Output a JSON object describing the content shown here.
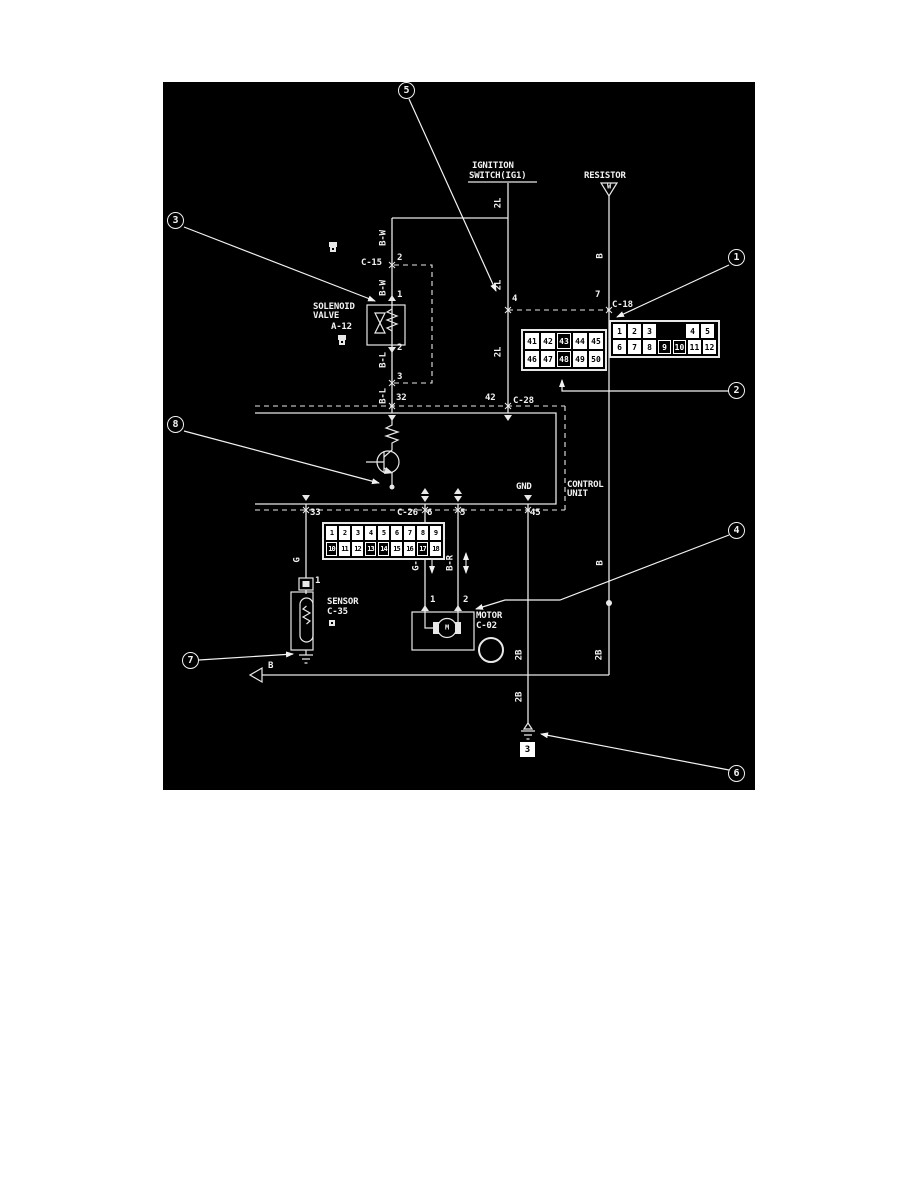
{
  "diagram": {
    "background": "#000000",
    "foreground": "#f2f2f2",
    "callouts": {
      "c1": "1",
      "c2": "2",
      "c3": "3",
      "c4": "4",
      "c5": "5",
      "c6": "6",
      "c7": "7",
      "c8": "8"
    }
  },
  "components": {
    "ignition_switch": {
      "line1": "IGNITION",
      "line2": "SWITCH(IG1)"
    },
    "resistor": {
      "label": "RESISTOR",
      "symbol_letter": "W"
    },
    "solenoid_valve": {
      "line1": "SOLENOID",
      "line2": "VALVE",
      "connector": "A-12"
    },
    "control_unit": {
      "line1": "CONTROL",
      "line2": "UNIT",
      "gnd_label": "GND"
    },
    "sensor": {
      "label": "SENSOR",
      "connector": "C-35"
    },
    "motor": {
      "label": "MOTOR",
      "connector": "C-02",
      "symbol_letter": "M"
    },
    "ground_ref": "3",
    "offpage_label": "B"
  },
  "connectors": {
    "c15": {
      "label": "C-15",
      "rows": [
        [
          "1",
          "2"
        ],
        [
          "3",
          "4"
        ]
      ]
    },
    "a12": {
      "rows": [
        [
          "1"
        ],
        [
          "2"
        ]
      ]
    },
    "c18": {
      "label": "C-18",
      "rows": [
        [
          "1",
          "2",
          "3",
          "",
          "4",
          "5"
        ],
        [
          "6",
          "7",
          "8",
          "9",
          "10",
          "11",
          "12"
        ]
      ],
      "filled": [
        "9",
        "10"
      ]
    },
    "c28": {
      "label": "C-28",
      "rows": [
        [
          "41",
          "42",
          "43",
          "44",
          "45"
        ],
        [
          "46",
          "47",
          "48",
          "49",
          "50"
        ]
      ],
      "filled": [
        "43",
        "48"
      ]
    },
    "c26": {
      "label": "C-26",
      "rows": [
        [
          "1",
          "2",
          "3",
          "4",
          "5",
          "6",
          "7",
          "8",
          "9"
        ],
        [
          "10",
          "11",
          "12",
          "13",
          "14",
          "15",
          "16",
          "17",
          "18"
        ]
      ],
      "filled": [
        "10",
        "13",
        "14",
        "17"
      ]
    },
    "c02_icon": {
      "rows": [
        [
          "1",
          "2"
        ]
      ]
    },
    "c35_icon": {
      "rows": [
        [
          "1"
        ]
      ]
    }
  },
  "pins": {
    "c15_top": "2",
    "valve_in": "1",
    "valve_out": "2",
    "c15_bottom": "3",
    "cu_32": "32",
    "cu_42": "42",
    "c18_4": "4",
    "c18_7": "7",
    "cu_33": "33",
    "cu_6": "6",
    "cu_5": "5",
    "cu_45": "45",
    "motor_1": "1",
    "motor_2": "2",
    "sensor_1": "1"
  },
  "wire_labels": {
    "l2l_a": "2L",
    "l2l_b": "2L",
    "l2l_c": "2L",
    "bw_a": "B-W",
    "bw_b": "B-W",
    "bl_a": "B-L",
    "bl_b": "B-L",
    "b_a": "B",
    "b_b": "B",
    "g": "G",
    "gr": "G-R",
    "br": "B-R",
    "b2_a": "2B",
    "b2_b": "2B",
    "b2_c": "2B",
    "b_bottom": "B"
  }
}
